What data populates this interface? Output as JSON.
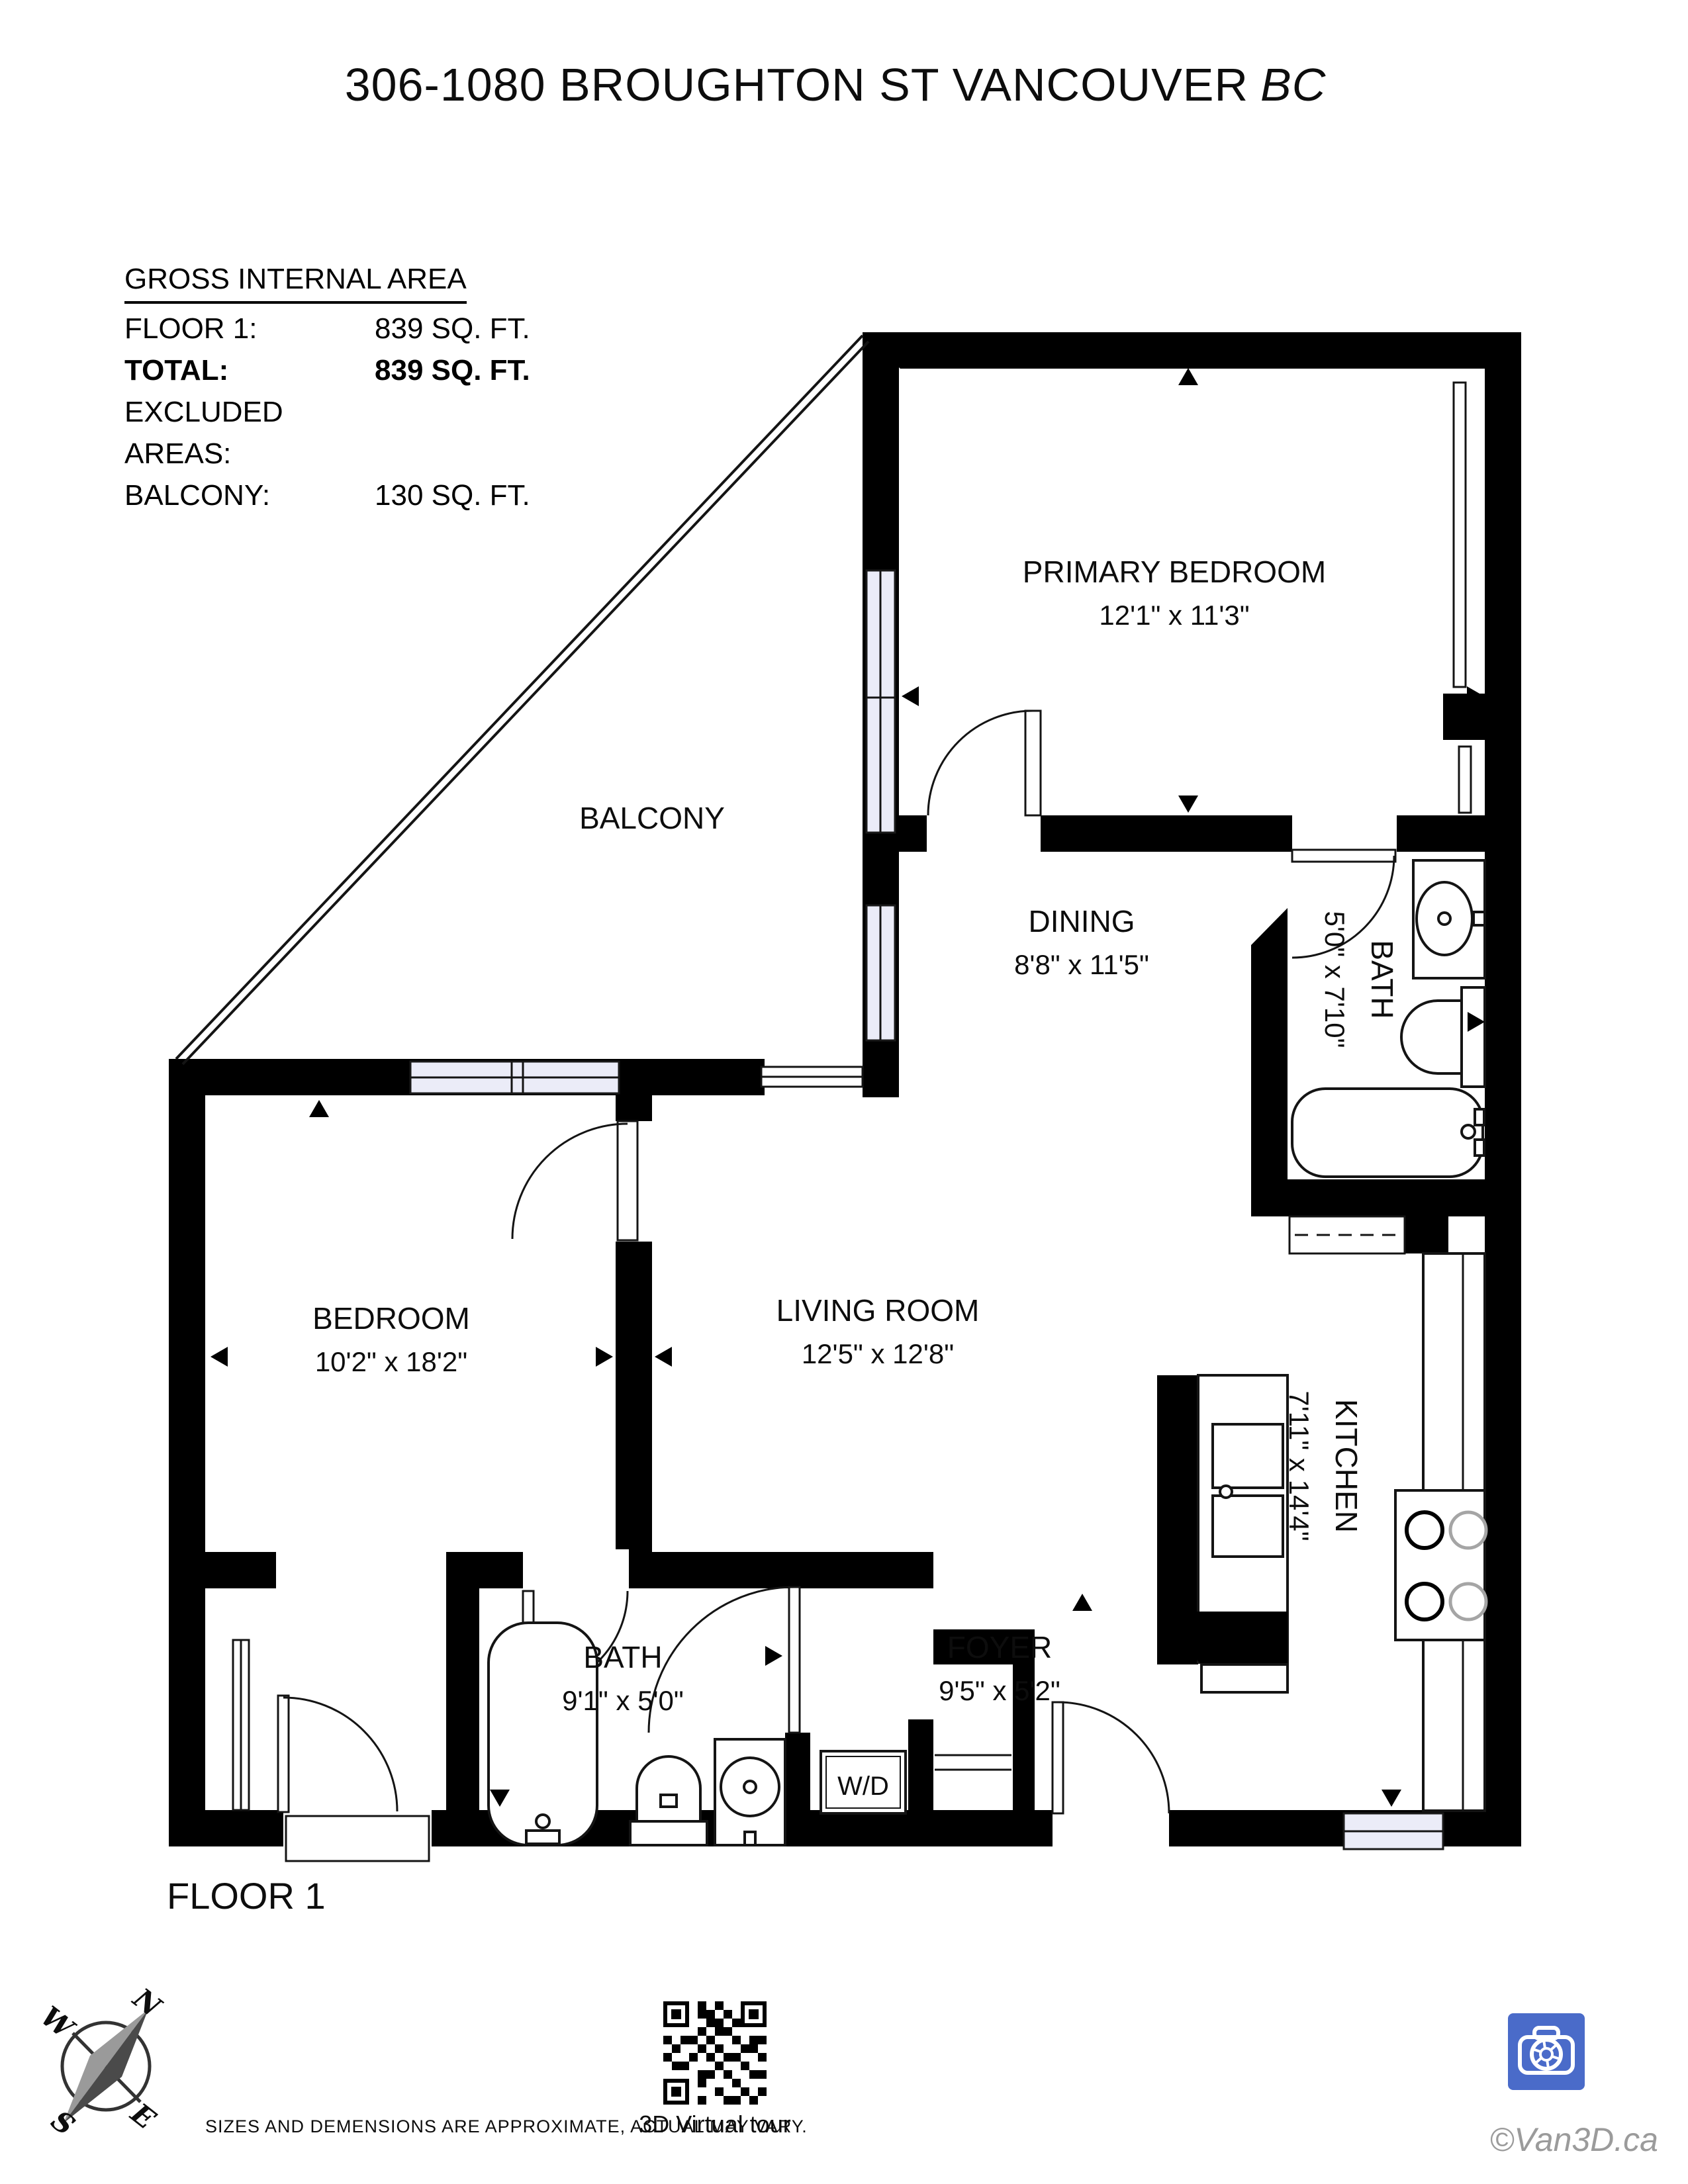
{
  "title": {
    "address": "306-1080 BROUGHTON ST VANCOUVER",
    "region": "BC"
  },
  "area_summary": {
    "heading": "GROSS INTERNAL AREA",
    "rows": [
      {
        "label": "FLOOR 1:",
        "value": "839 SQ. FT."
      },
      {
        "label": "TOTAL:",
        "value": "839 SQ. FT."
      },
      {
        "label": "EXCLUDED AREAS:",
        "value": ""
      },
      {
        "label": "BALCONY:",
        "value": "130 SQ. FT."
      }
    ]
  },
  "rooms": [
    {
      "name": "PRIMARY BEDROOM",
      "dims": "12'1\" x 11'3\""
    },
    {
      "name": "BALCONY",
      "dims": ""
    },
    {
      "name": "DINING",
      "dims": "8'8\" x 11'5\""
    },
    {
      "name": "BATH",
      "dims": "5'0\" x 7'10\""
    },
    {
      "name": "BEDROOM",
      "dims": "10'2\" x 18'2\""
    },
    {
      "name": "LIVING ROOM",
      "dims": "12'5\" x 12'8\""
    },
    {
      "name": "KITCHEN",
      "dims": "7'11\" x 14'4\""
    },
    {
      "name": "BATH",
      "dims": "9'1\" x 5'0\""
    },
    {
      "name": "FOYER",
      "dims": "9'5\" x 5'2\""
    }
  ],
  "labels": {
    "washer_dryer": "W/D",
    "floor": "FLOOR 1"
  },
  "compass": {
    "n": "N",
    "e": "E",
    "s": "S",
    "w": "W"
  },
  "footer": {
    "disclaimer": "SIZES AND DEMENSIONS ARE APPROXIMATE, ACTUAL MAY VARY.",
    "qr_caption": "3D Virtual tour",
    "watermark": "©Van3D.ca"
  },
  "colors": {
    "wall": "#000000",
    "window_fill": "#ebecf8",
    "logo_blue": "#4a6bc9",
    "watermark_gray": "#9b9b9b"
  }
}
